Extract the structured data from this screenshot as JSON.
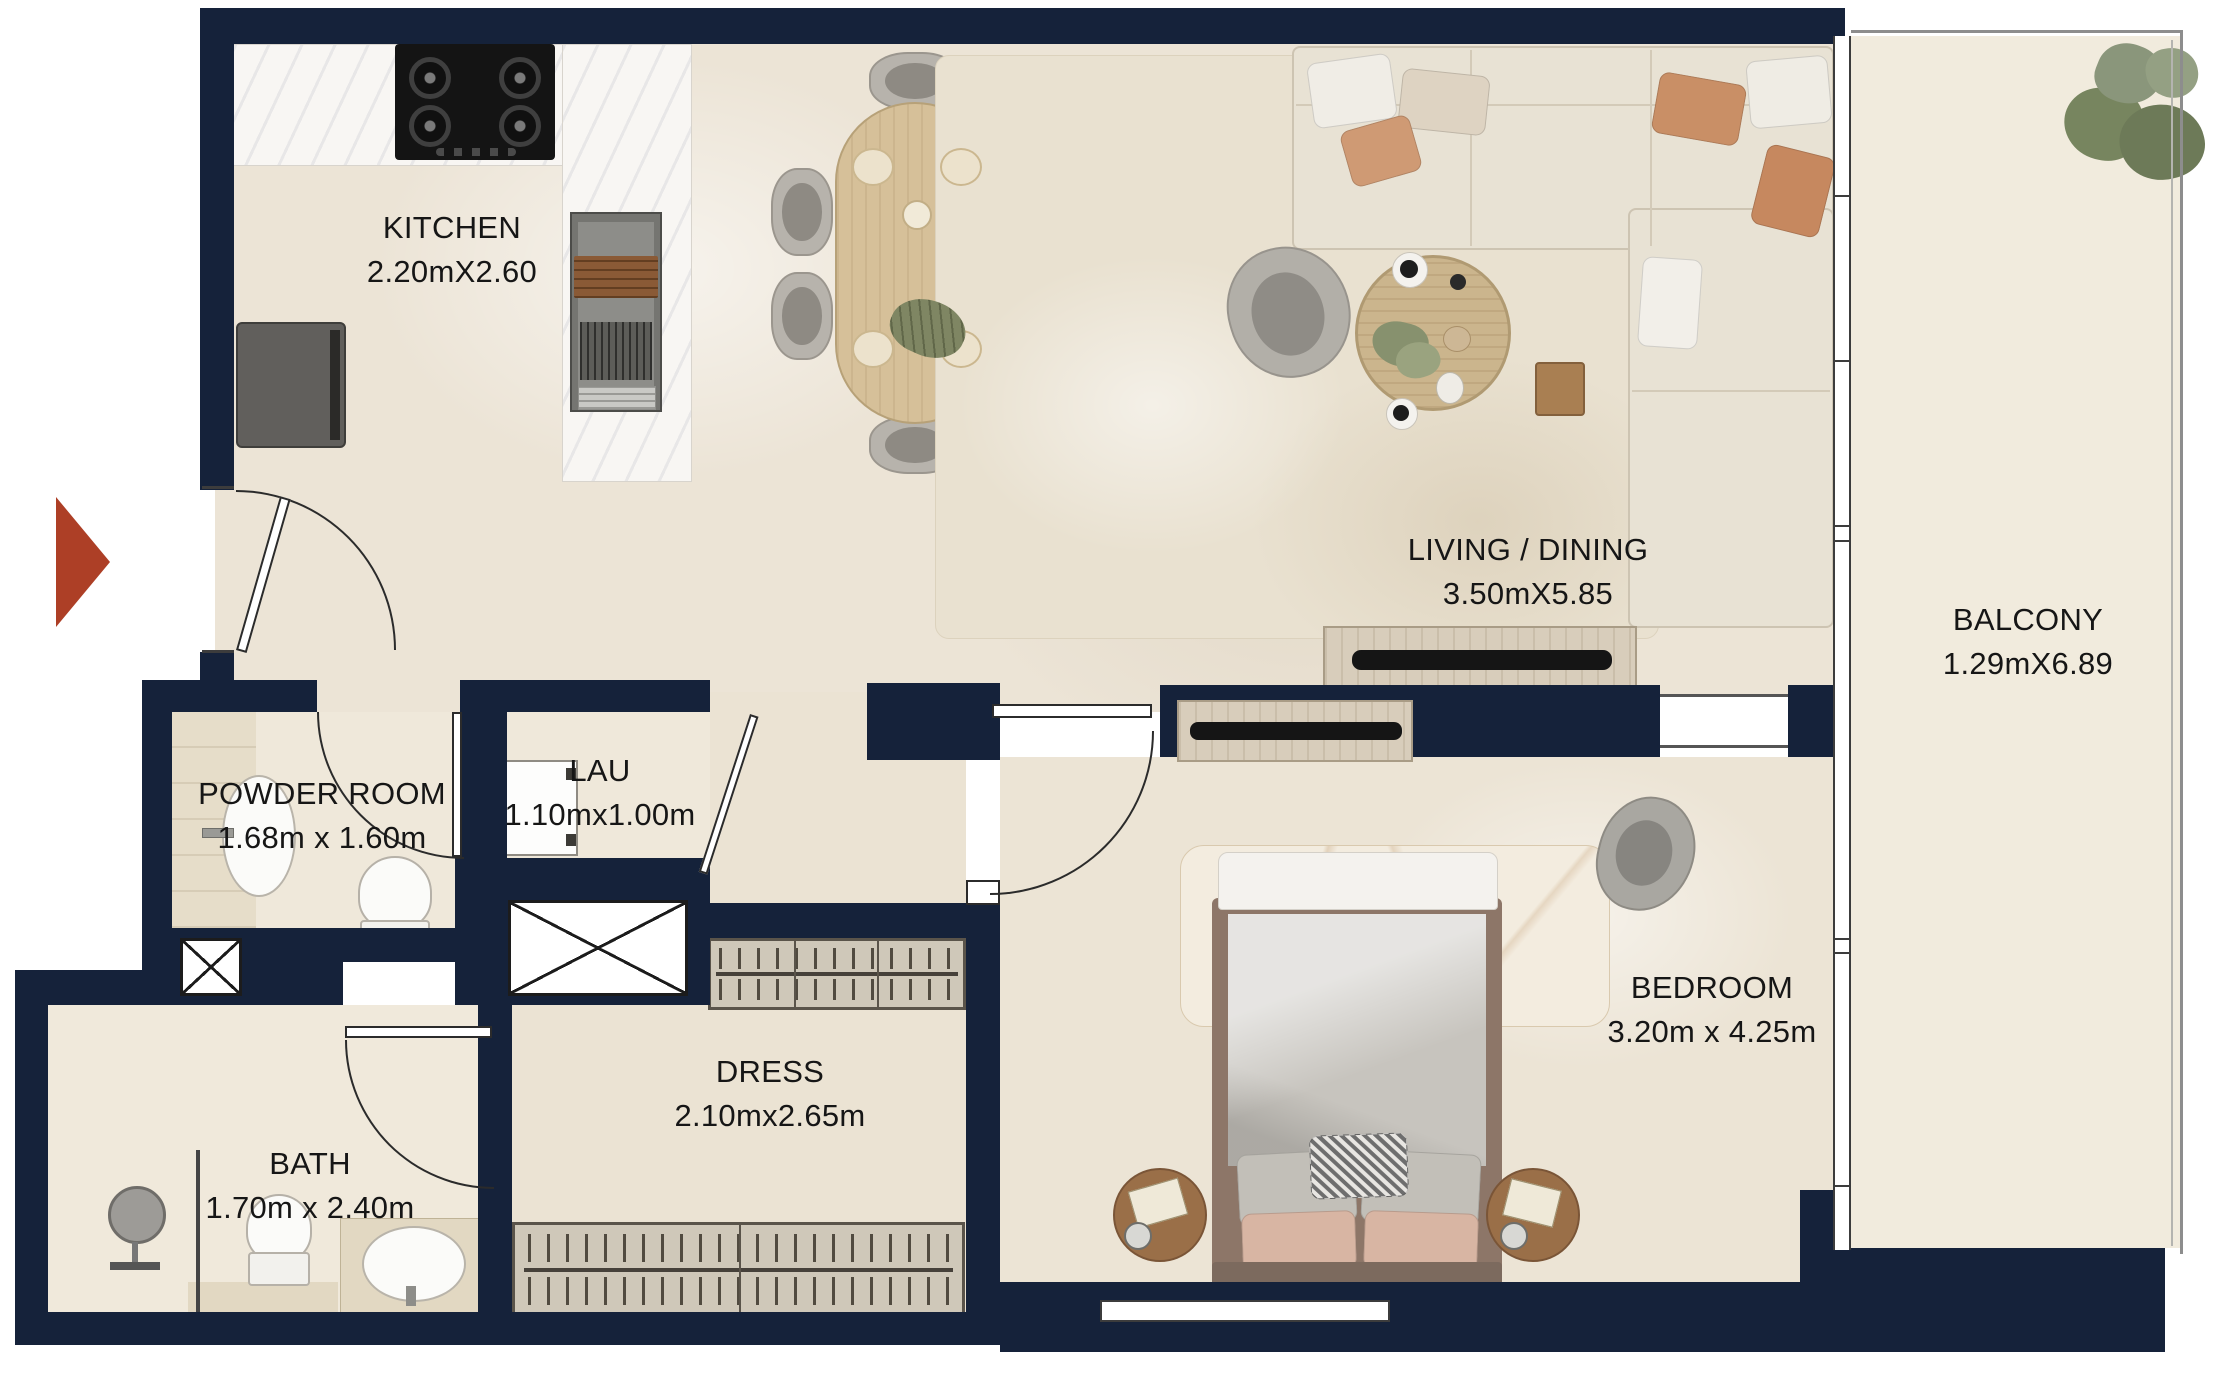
{
  "plan_title": "Apartment unit floor plan",
  "rooms": {
    "kitchen": {
      "name": "KITCHEN",
      "dims": "2.20mX2.60"
    },
    "living_dining": {
      "name": "LIVING / DINING",
      "dims": "3.50mX5.85"
    },
    "balcony": {
      "name": "BALCONY",
      "dims": "1.29mX6.89"
    },
    "powder_room": {
      "name": "POWDER ROOM",
      "dims": "1.68m x 1.60m"
    },
    "laundry": {
      "name": "LAU",
      "dims": "1.10mx1.00m"
    },
    "dressing": {
      "name": "DRESS",
      "dims": "2.10mx2.65m"
    },
    "bath": {
      "name": "BATH",
      "dims": "1.70m x 2.40m"
    },
    "bedroom": {
      "name": "BEDROOM",
      "dims": "3.20m x 4.25m"
    }
  },
  "colors": {
    "wall": "#15223a",
    "floor": "#ece4d6",
    "balcony_floor": "#f1ebdd",
    "entrance_arrow": "#ad3f26",
    "wood": "#d6c099",
    "sofa": "#e8e2d4",
    "label_text": "#161616"
  },
  "icons": {
    "entrance_marker": "right-pointing-triangle",
    "shaft_symbol": "crossed-box",
    "wardrobe_symbol": "hanger-rail"
  }
}
